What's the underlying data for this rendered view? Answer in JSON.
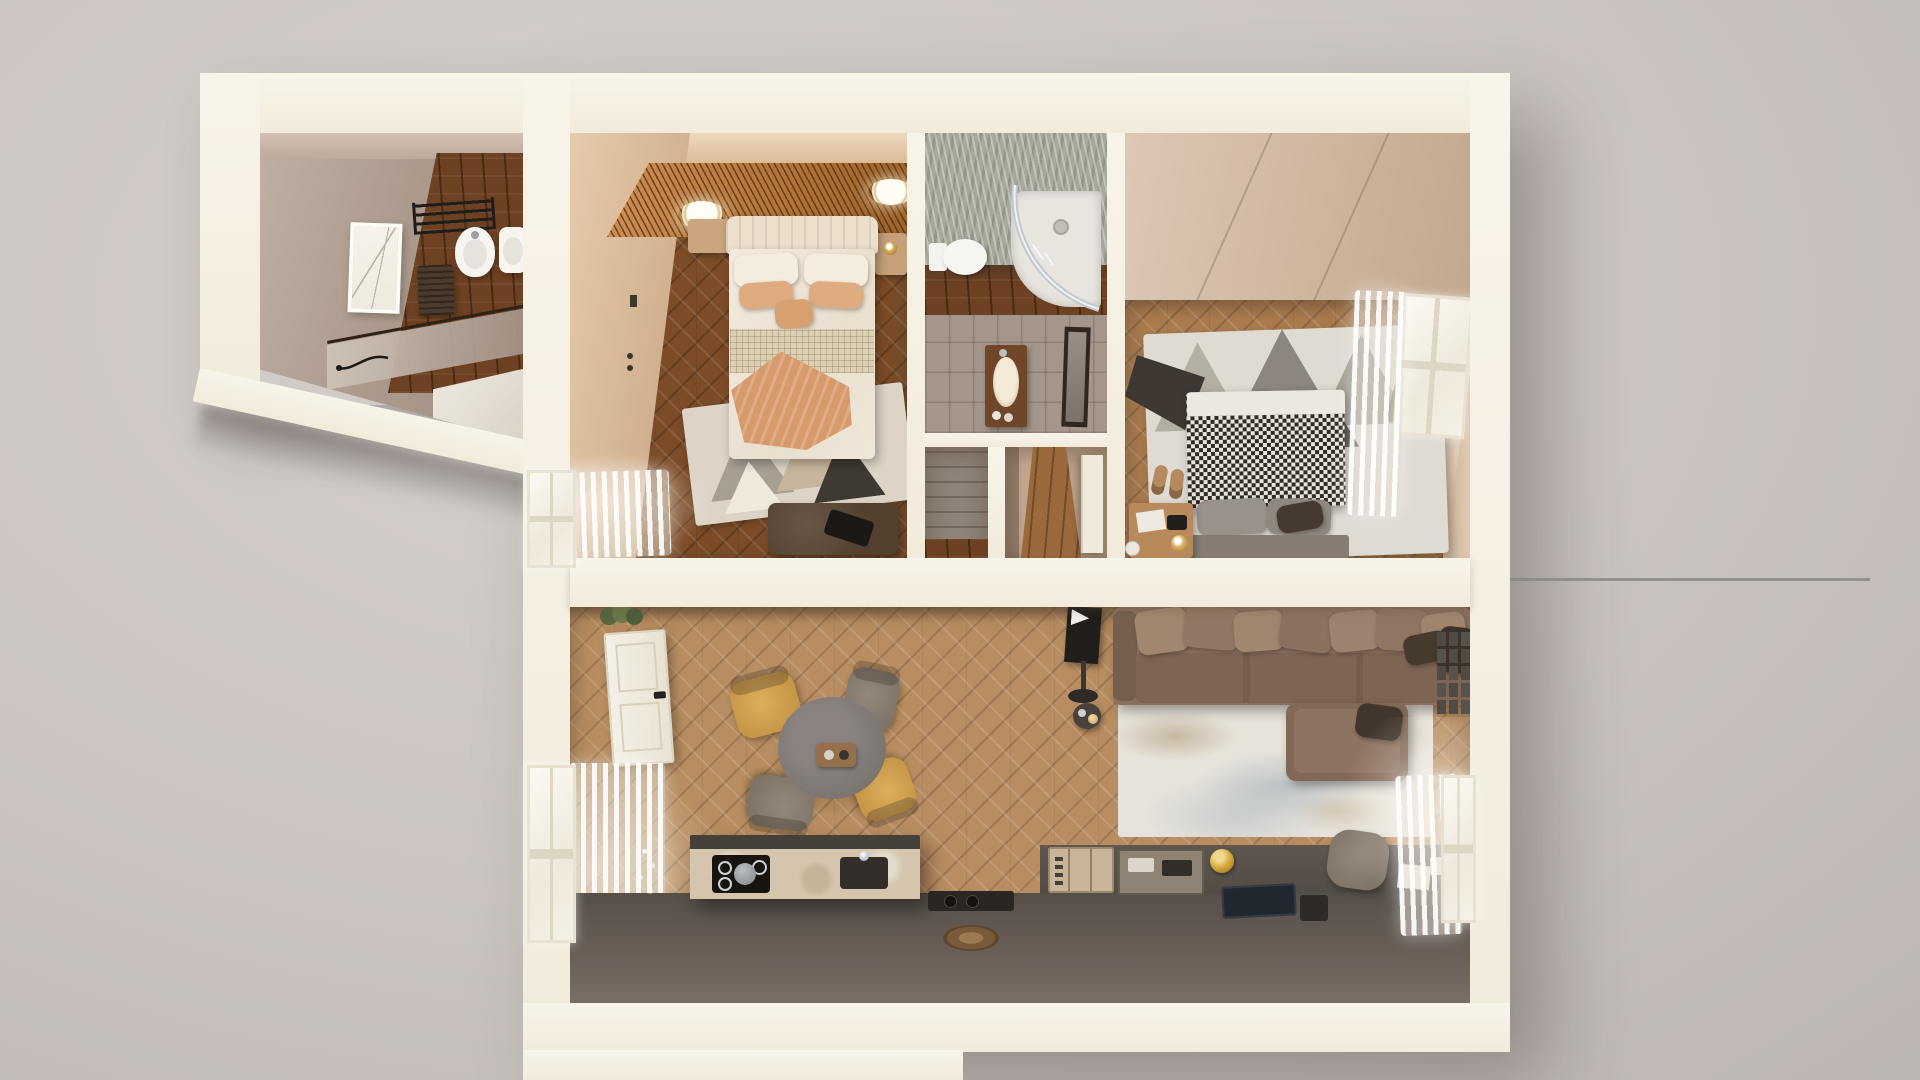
{
  "scene": {
    "kind": "3d-floorplan-render",
    "view": "top-down dollhouse cutaway",
    "apartment": "two-bedroom apartment with living-kitchen and two bathrooms",
    "visible_text": "none"
  },
  "palette": {
    "background_gray": "#cbc4c1",
    "wall_cream": "#f5efe3",
    "floor_dark_wood": "#7c4c28",
    "floor_mid_wood": "#ab7c4f",
    "floor_light_wood": "#b88d61",
    "ceiling_slats_orange": "#c47c35",
    "bathroom_ceiling_gray": "#a7a79c",
    "kitchen_counter_dark": "#5b534c",
    "travertine": "#d4c5ac",
    "sofa_taupe": "#8b7060",
    "chair_yellow": "#d2a050",
    "chair_gray": "#8a7e72",
    "houndstooth_dark": "#2e2a26",
    "houndstooth_light": "#e9e4da",
    "peach_throw": "#d79a6b",
    "rug_cream": "#e8e3da"
  },
  "rooms": [
    {
      "id": "bathroom-annex",
      "name": "Annex bathroom",
      "furniture": [
        "towel-rack",
        "bidet",
        "toilet",
        "framed-art",
        "wood-cabinet",
        "glass-screen",
        "hand-shower",
        "bathtub"
      ]
    },
    {
      "id": "bedroom-main",
      "name": "Main bedroom",
      "furniture": [
        "slatted-ceiling",
        "ceiling-lamps",
        "double-bed",
        "headboard",
        "pillows",
        "knit-runner",
        "peach-throw",
        "nightstands",
        "geometric-rug",
        "bench-with-clutch",
        "window-curtain",
        "wall-sconce"
      ]
    },
    {
      "id": "bathroom-shower",
      "name": "Shower bathroom",
      "furniture": [
        "textured-ceiling",
        "toilet",
        "corner-shower",
        "vanity-sink",
        "mirror"
      ]
    },
    {
      "id": "closet",
      "name": "Closet",
      "furniture": [
        "paneled-wardrobe"
      ]
    },
    {
      "id": "hallway",
      "name": "Hallway",
      "furniture": [
        "interior-door"
      ]
    },
    {
      "id": "bedroom-second",
      "name": "Second bedroom",
      "furniture": [
        "cut-ceiling-panel",
        "houndstooth-bed",
        "gray-pillows",
        "headboard",
        "nightstand",
        "table-lamp",
        "papers",
        "camera",
        "mountain-rug",
        "dark-throw",
        "slippers",
        "window",
        "sheer-curtain"
      ]
    },
    {
      "id": "living-kitchen",
      "name": "Living room and kitchen",
      "furniture": [
        "front-door",
        "plant",
        "dining-table",
        "serving-tray",
        "yellow-chairs",
        "gray-chairs",
        "tv-on-pole",
        "side-stool",
        "sectional-sofa",
        "sofa-pillows",
        "chaise",
        "distressed-rug",
        "kitchen-island",
        "cooktop",
        "pot",
        "island-sink",
        "counter-run",
        "cutlery-organizers",
        "gold-canister",
        "laptop",
        "recessed-tray",
        "woven-trivet",
        "desk-chair",
        "paper-sheet",
        "gallery-frames",
        "windows",
        "sheer-curtains"
      ]
    }
  ]
}
